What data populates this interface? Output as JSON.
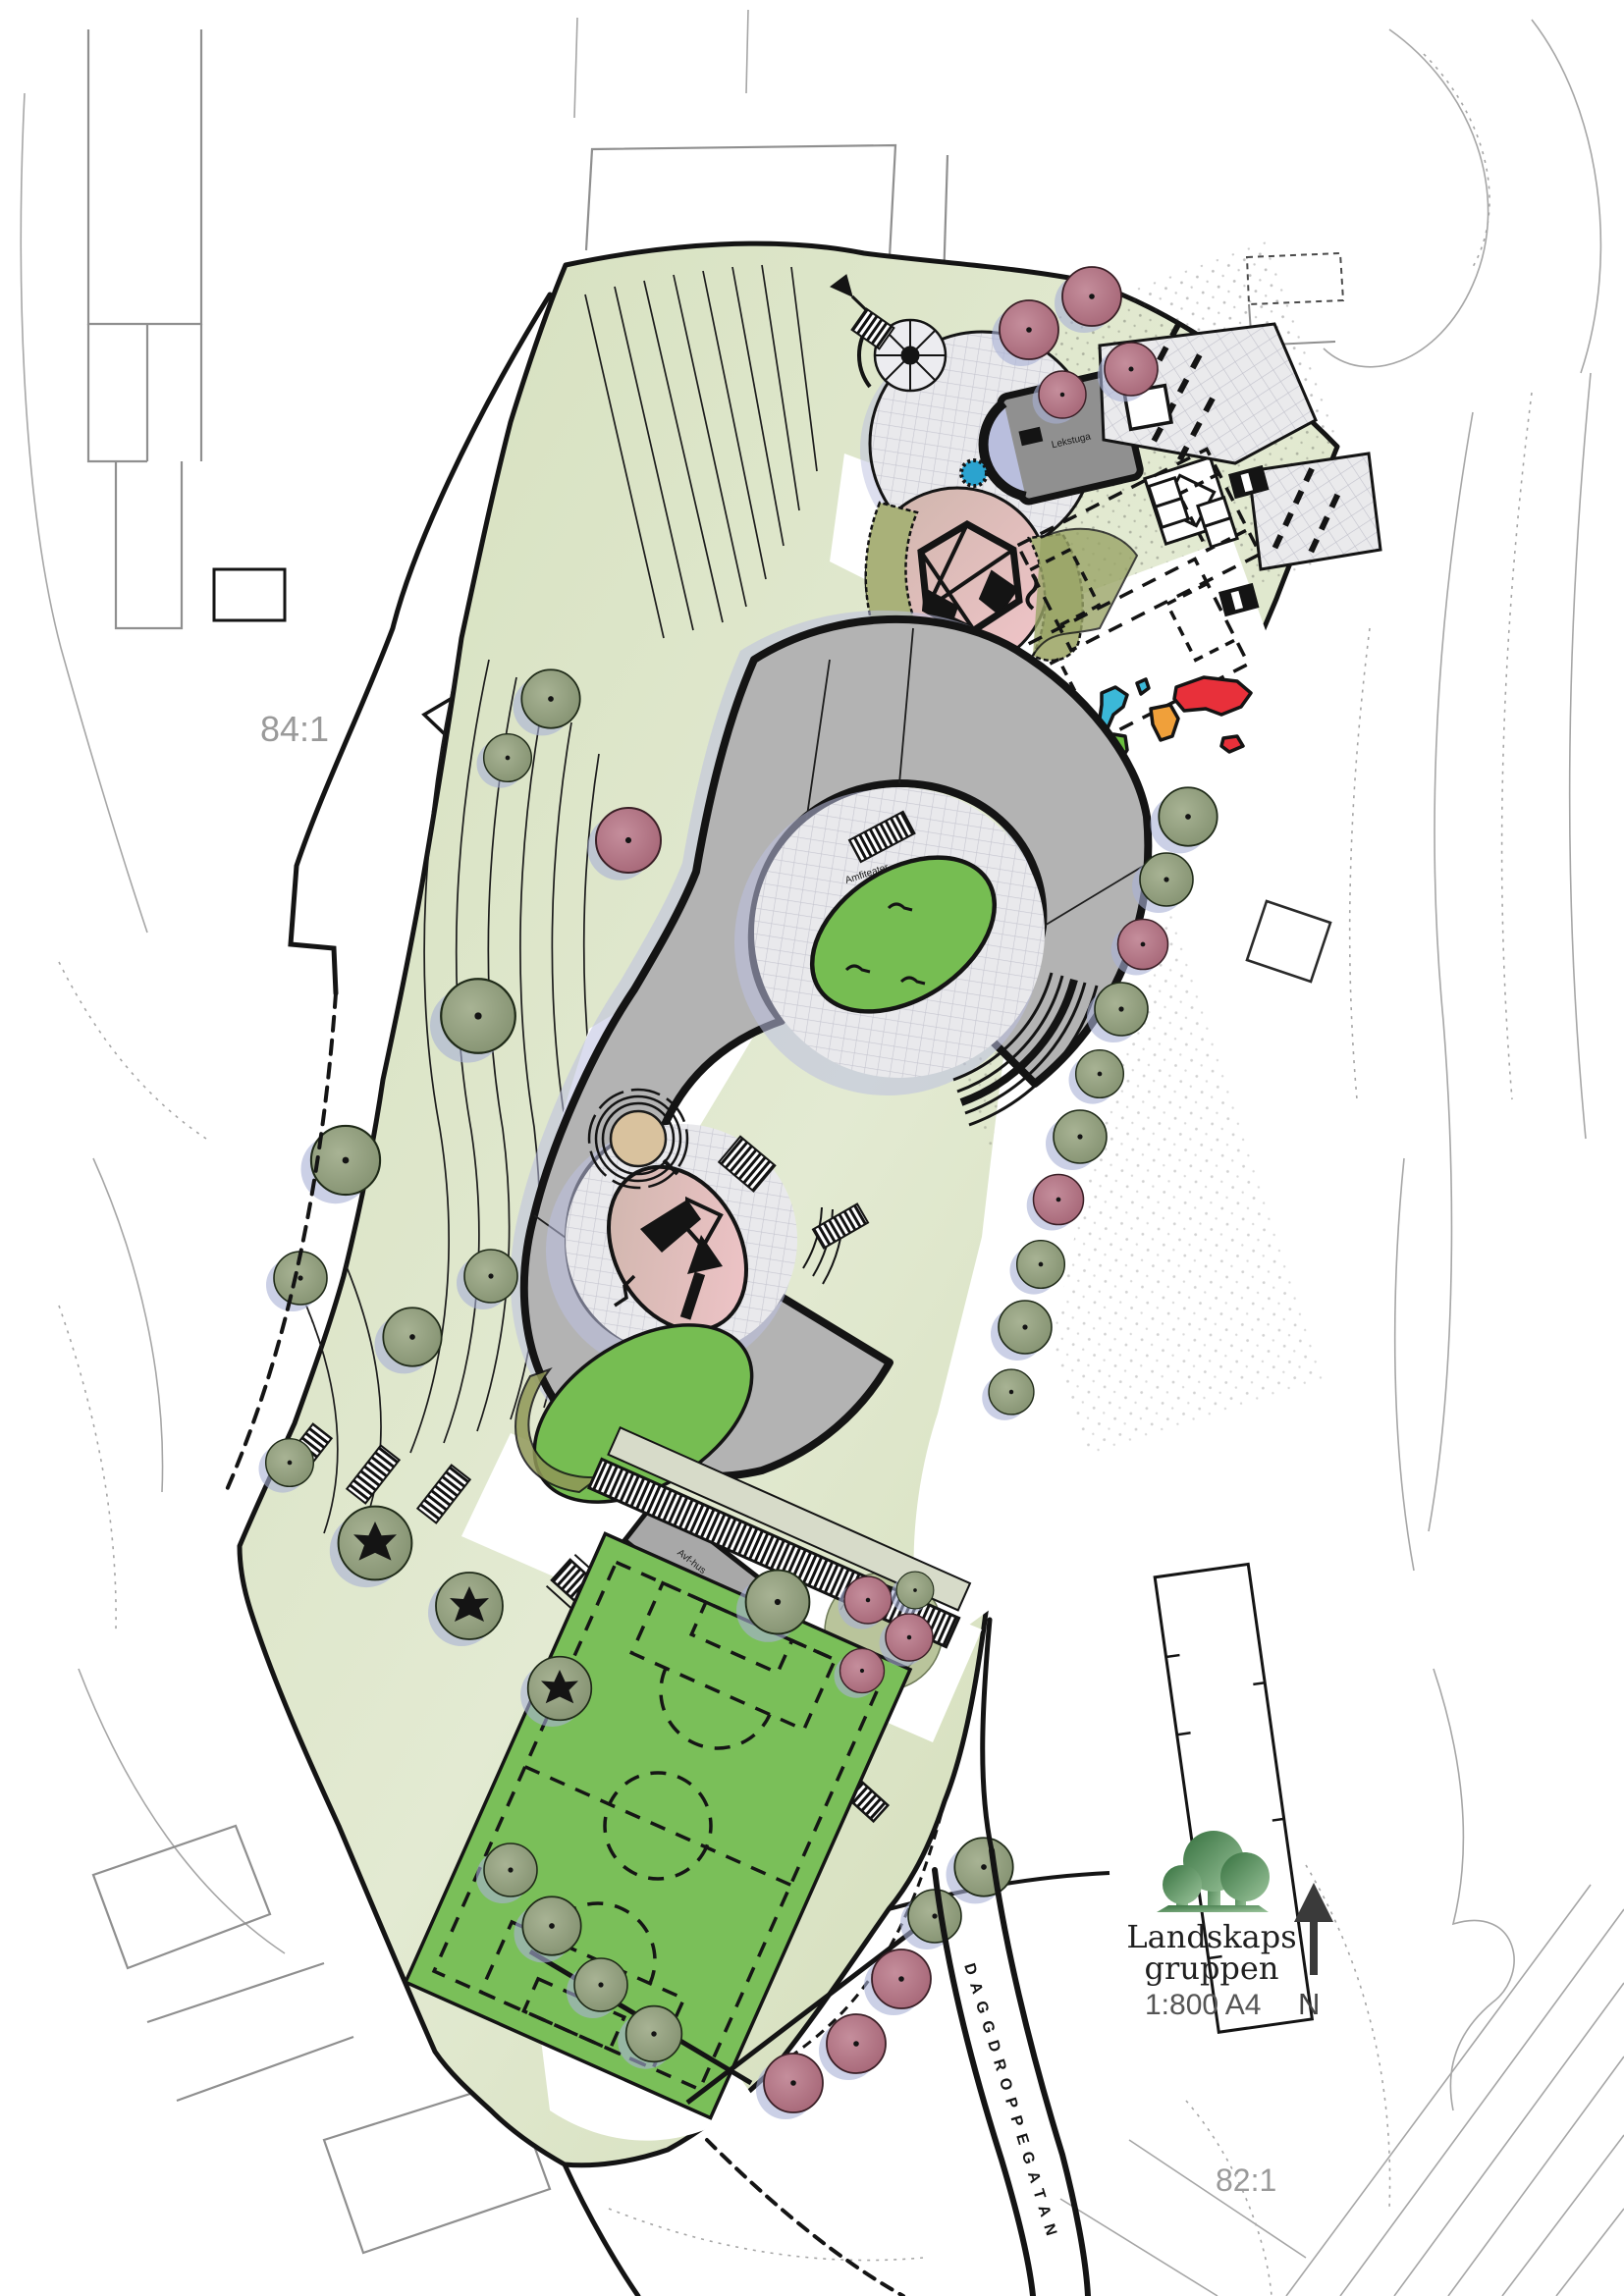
{
  "document": {
    "type": "landscape-site-plan",
    "firm": "Landskapsgruppen"
  },
  "logo": {
    "line1": "Landskaps",
    "line2": "gruppen"
  },
  "legend": {
    "scale": "1:800 A4",
    "north": "N"
  },
  "labels": {
    "street": "DAGGDROPPEGATAN",
    "parcel_left": "84:1",
    "parcel_right": "82:1",
    "shed": "Lekstuga",
    "amphitheatre": "Amfiteater",
    "waste_house": "Avf-hus"
  },
  "colors": {
    "building_gray": "#b3b3b3",
    "building_outline": "#141414",
    "paving_light": "#e9e9ec",
    "paving_grid": "#c6c6d0",
    "shadow_lavender": "#bcc0e0",
    "site_green_light": "#e2e9d0",
    "site_green": "#cbd6af",
    "lawn_green": "#76bd52",
    "field_green": "#7abf59",
    "tree_sage": "#96a482",
    "tree_rose": "#b5798a",
    "play_pink": "#f0c3c8",
    "sand_tan": "#d9c29e",
    "water_blue": "#2ba3cf",
    "contour_gray": "#a6a6a6",
    "logo_green_dark": "#36713f",
    "logo_green_light": "#9cc59c",
    "map_blue": "#3bb8d8",
    "map_green": "#6abf3f",
    "map_orange": "#f0a03a",
    "map_red": "#e8303a"
  },
  "features": [
    "s-shaped-building",
    "upper-courtyard-lawn",
    "lower-courtyard-playground",
    "amphitheatre-steps",
    "north-playground",
    "climbing-tower",
    "world-map-mural",
    "ball-courts",
    "bike-parking",
    "football-field",
    "terraced-hill",
    "tree-rows",
    "north-arrow"
  ]
}
